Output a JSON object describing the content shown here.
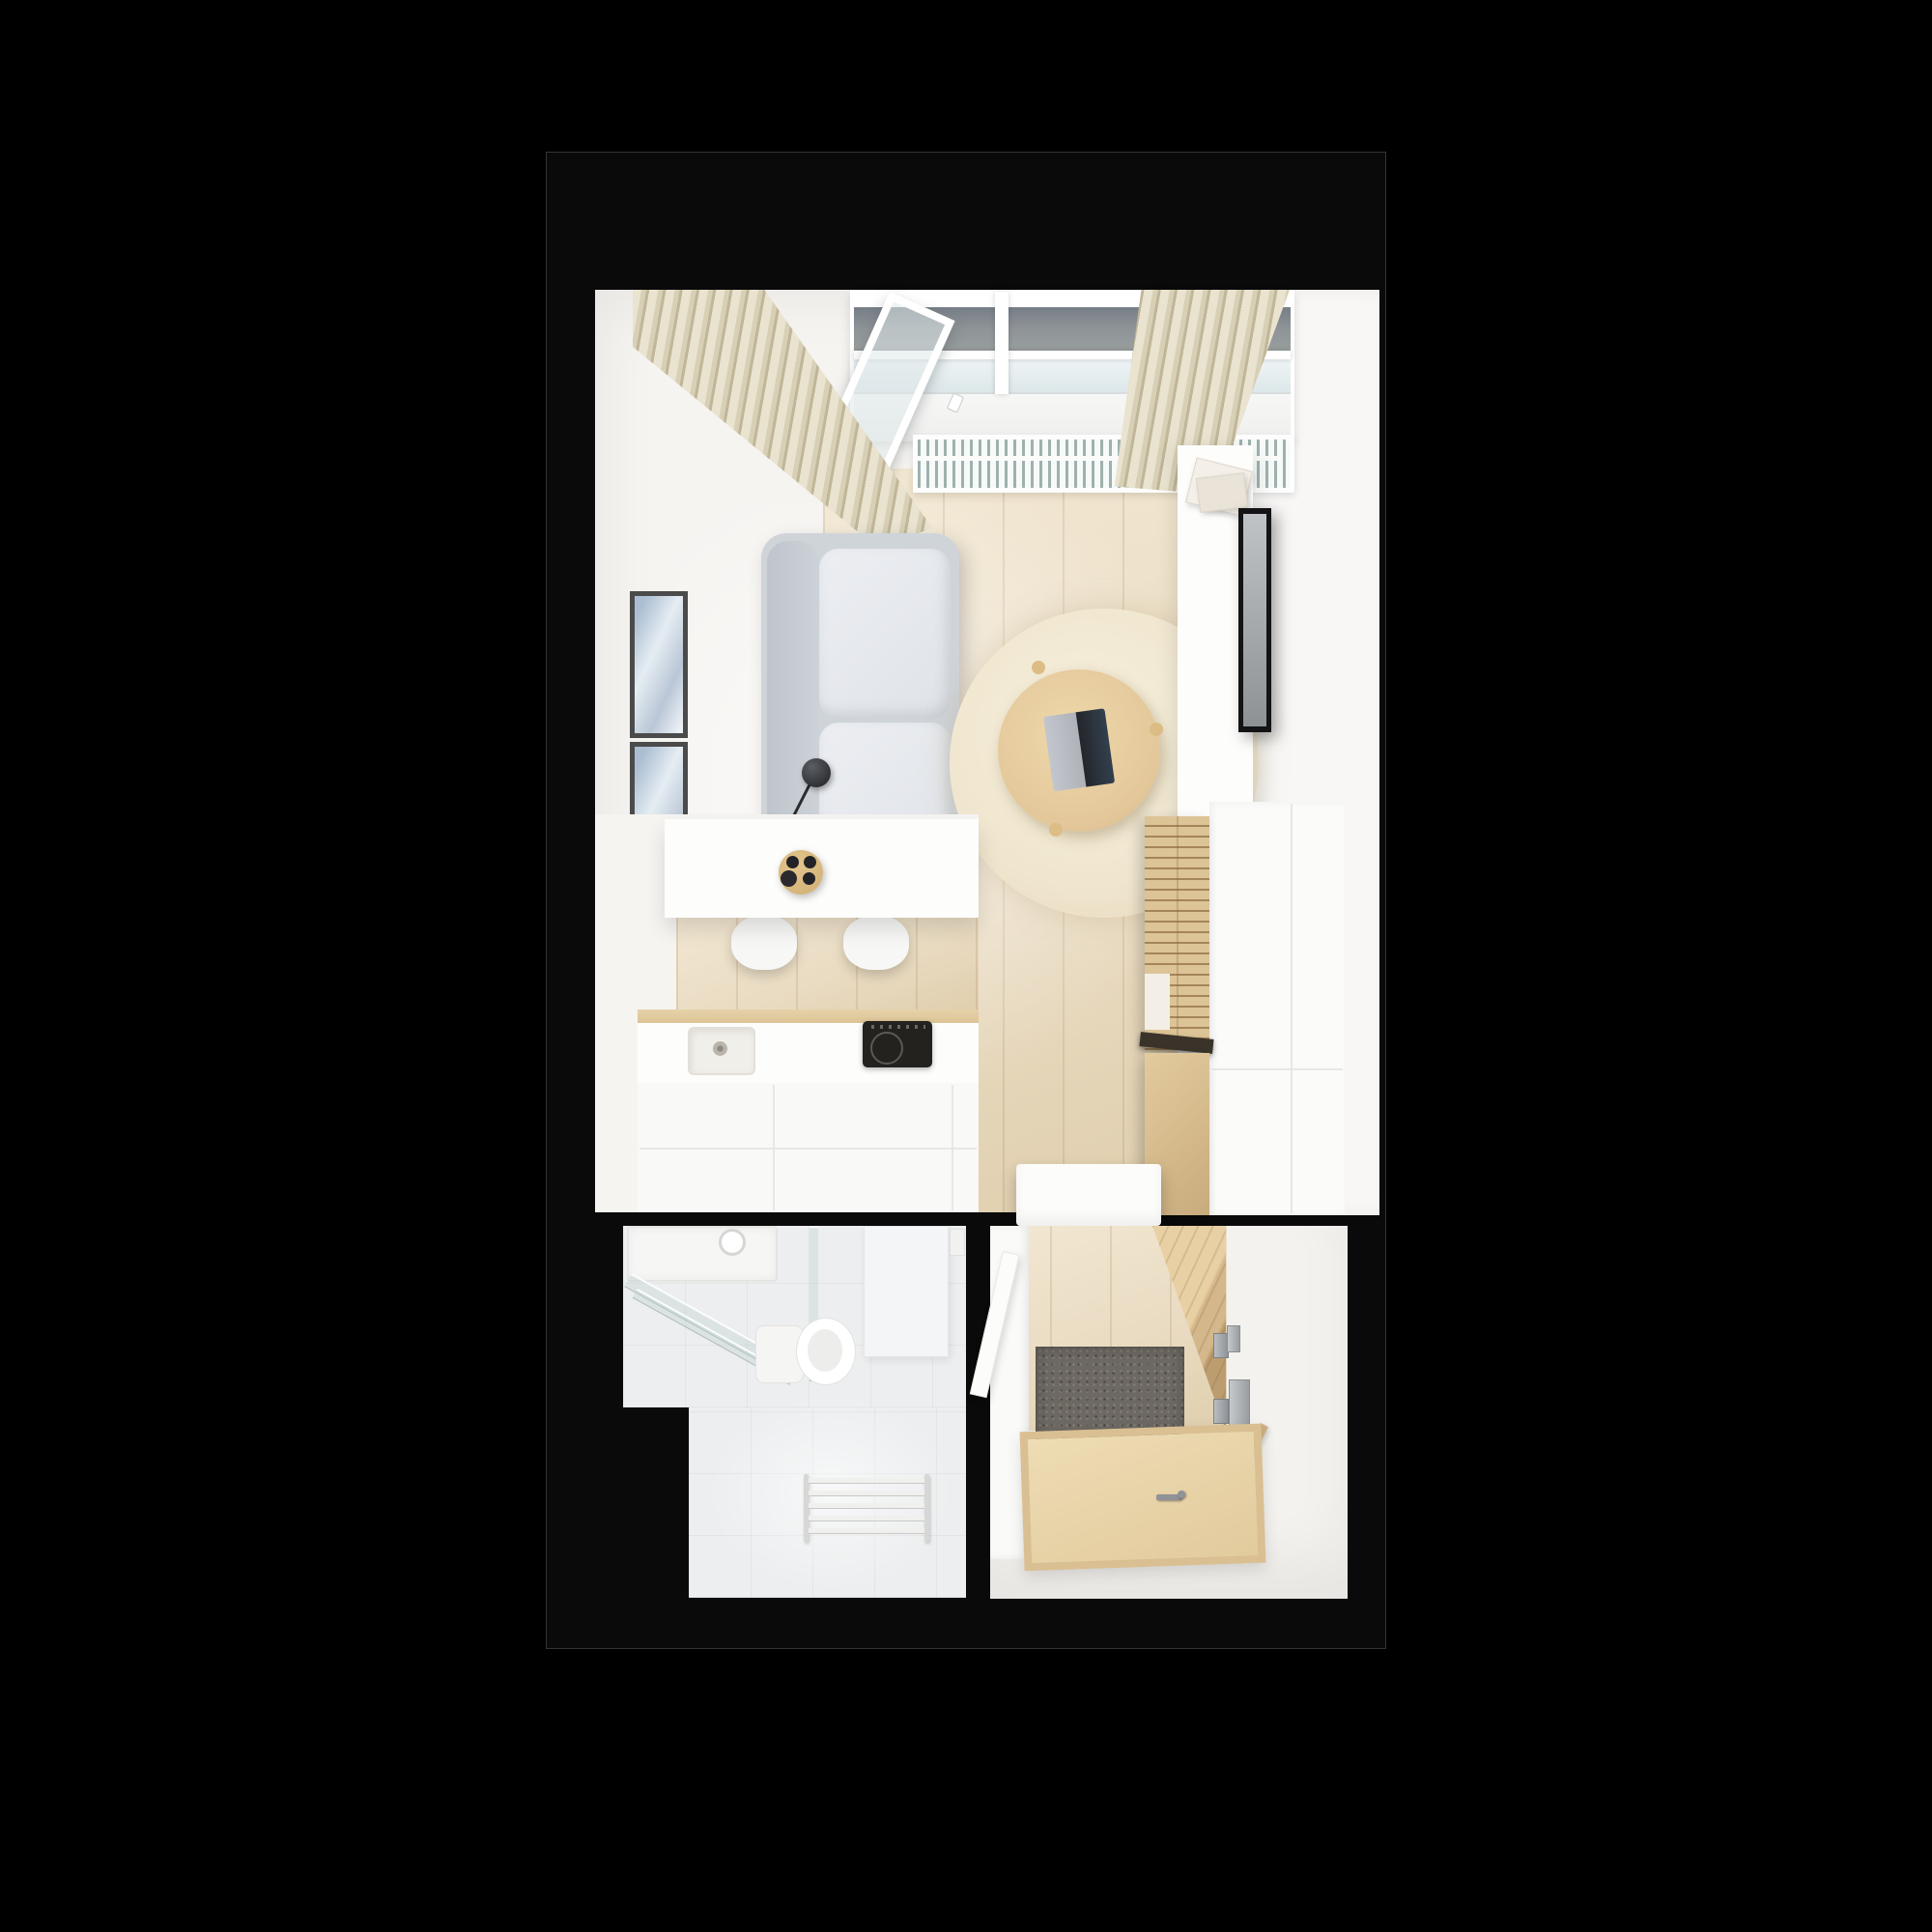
{
  "scene": {
    "kind": "top-down 3D floor plan render of a studio apartment",
    "rooms": {
      "living_room": [
        "window-wall",
        "open-window-sash",
        "floor-radiator-grille",
        "curtain-left",
        "curtain-right",
        "wall-art-frames",
        "sofa",
        "floor-lamp",
        "round-rug",
        "coffee-table",
        "laptop",
        "tv-wall-panel",
        "tv",
        "magazines",
        "wardrobe-slat-door",
        "wardrobe-lower-door",
        "wardrobe-side-cabinet",
        "storage-bench",
        "dining-counter",
        "serving-tray",
        "espresso-cups",
        "bar-stools",
        "kitchen-counter",
        "kitchen-sink",
        "induction-cooktop"
      ],
      "bathroom": [
        "shower-tray",
        "shower-head",
        "shower-glass-door",
        "toilet",
        "bath-mat",
        "paper-holder",
        "towel-radiator"
      ],
      "entry_hall": [
        "hallway-cabinet",
        "hallway-cabinet-door",
        "doormat",
        "entrance-door-open",
        "door-hinges",
        "strike-plate",
        "door-frame-strips",
        "entry-landing",
        "landing-handle"
      ]
    }
  },
  "colors": {
    "bg": "#000000",
    "block": "#0a0a0b",
    "blockBorder": "#343434",
    "roomBase": "#f6f4f1",
    "wood": "#eadcc3",
    "woodHi": "#f2e7d2",
    "woodLo": "#e0cfae",
    "tile": "#eceeef",
    "curtain": "#d8d0b6",
    "curtainHi": "#e9e3d0",
    "curtainLo": "#c0b698",
    "radSlat": "#9fb1ad",
    "sofa": "#cfd4d9",
    "rug": "#f0e6cf",
    "tableWood": "#e3c79a",
    "slatWood": "#dcc497",
    "slatLine": "#a5855a",
    "mat": "#6d6862"
  }
}
